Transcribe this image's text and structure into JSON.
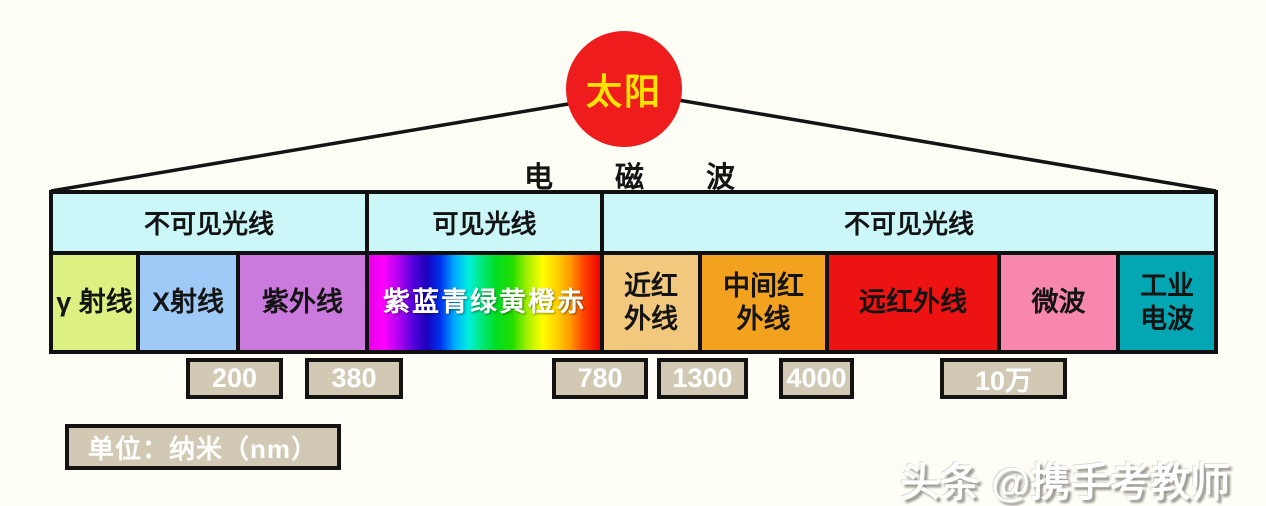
{
  "background_color": "#FFFEF6",
  "sun": {
    "label": "太阳",
    "color": "#EE1C1C",
    "text_color": "#FFE400"
  },
  "title": {
    "label": "电磁波"
  },
  "spectrum": {
    "headers": [
      {
        "label": "不可见光线",
        "color": "#CBF7F8"
      },
      {
        "label": "可见光线",
        "color": "#CBF7F8"
      },
      {
        "label": "不可见光线",
        "color": "#CBF7F8"
      }
    ],
    "bands": [
      {
        "label": "γ 射线",
        "color": "#DDF183"
      },
      {
        "label": "X射线",
        "color": "#9FCAF7"
      },
      {
        "label": "紫外线",
        "color": "#CA79DD"
      },
      {
        "label": "紫蓝青绿黄橙赤",
        "color": "rainbow-gradient",
        "text_color": "#FFFFFF"
      },
      {
        "label": "近红\n外线",
        "color": "#F2C87E"
      },
      {
        "label": "中间红\n外线",
        "color": "#F2A21E"
      },
      {
        "label": "远红外线",
        "color": "#EE1313"
      },
      {
        "label": "微波",
        "color": "#F787AE"
      },
      {
        "label": "工业\n电波",
        "color": "#03A7B3"
      }
    ],
    "wavelength_markers": [
      {
        "value": "200"
      },
      {
        "value": "380"
      },
      {
        "value": "780"
      },
      {
        "value": "1300"
      },
      {
        "value": "4000"
      },
      {
        "value": "10万"
      }
    ],
    "marker_box_color": "#D1C9B4"
  },
  "unit_box": {
    "label": "单位：纳米（nm）"
  },
  "watermark": {
    "label": "头条 @携手考教师"
  }
}
